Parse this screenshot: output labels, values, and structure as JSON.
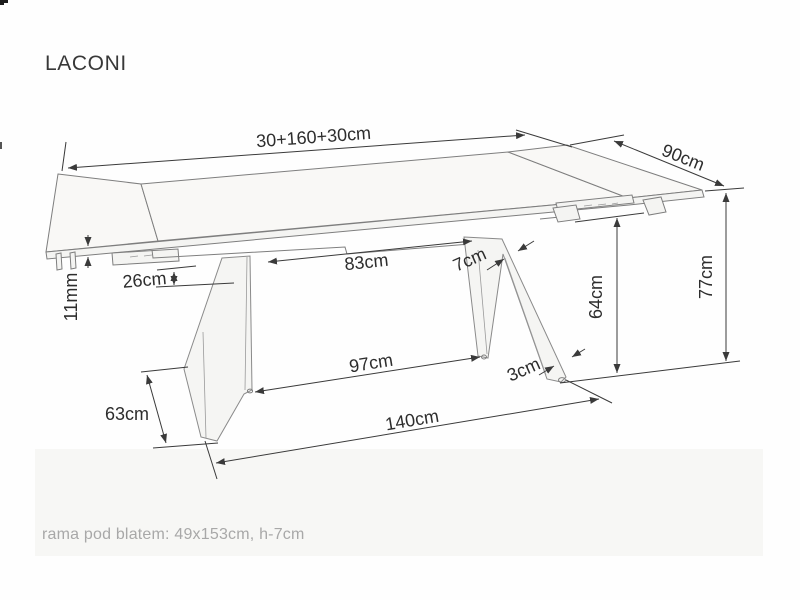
{
  "header": {
    "title": "LACONI"
  },
  "footer": {
    "note": "rama pod blatem: 49x153cm, h-7cm"
  },
  "dimensions": {
    "table_length": "30+160+30cm",
    "table_width": "90cm",
    "table_height": "77cm",
    "underframe_height": "64cm",
    "legs_top_clearance": "83cm",
    "leg_top_thickness": "7cm",
    "apron_offset": "26cm",
    "top_thickness": "11mm",
    "leg_foot_depth": "63cm",
    "feet_clearance": "97cm",
    "foot_thickness": "3cm",
    "base_length": "140cm"
  },
  "colors": {
    "dimension_lines": "#3a3a3a",
    "drawing_lines": "#7e7e7e",
    "label_text": "#2d2d2d",
    "note_text": "#a8a8a8",
    "background": "#fefefe",
    "tabletop_fill": "#f9f8f6"
  }
}
